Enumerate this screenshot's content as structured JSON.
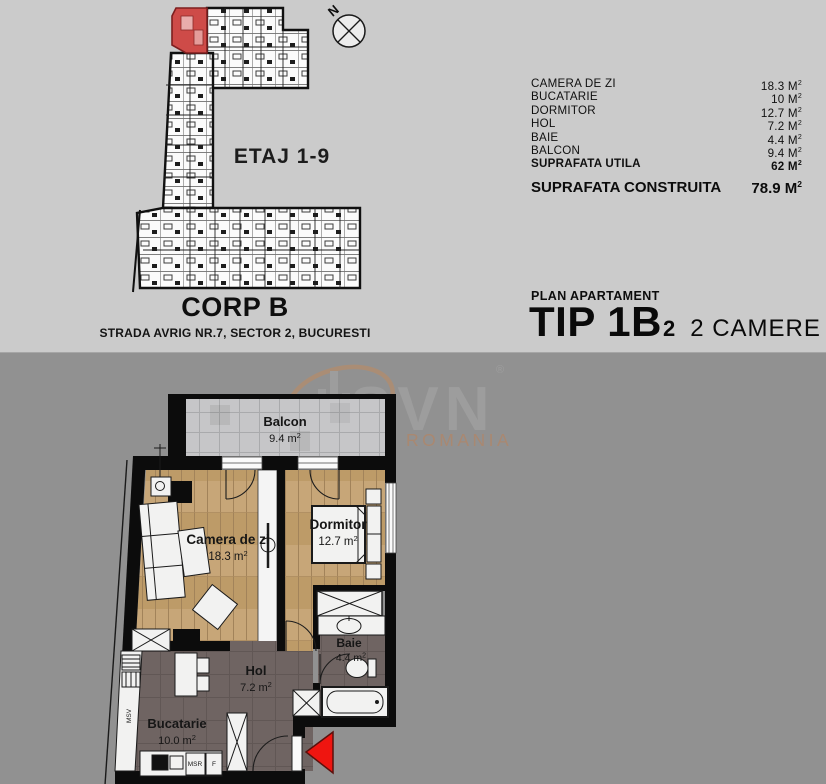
{
  "units": {
    "sup": "2"
  },
  "building": {
    "etaj": "ETAJ 1-9",
    "compass": "N",
    "corp": "CORP B",
    "address": "STRADA AVRIG NR.7, SECTOR 2, BUCURESTI"
  },
  "areas": {
    "rows": [
      {
        "label": "CAMERA DE ZI",
        "value": "18.3 M"
      },
      {
        "label": "BUCATARIE",
        "value": "10 M"
      },
      {
        "label": "DORMITOR",
        "value": "12.7 M"
      },
      {
        "label": "HOL",
        "value": "7.2 M"
      },
      {
        "label": "BAIE",
        "value": "4.4 M"
      },
      {
        "label": "BALCON",
        "value": "9.4 M"
      },
      {
        "label": "SUPRAFATA UTILA",
        "value": "62 M"
      }
    ],
    "construita": {
      "label": "SUPRAFATA CONSTRUITA",
      "value": "78.9 M"
    }
  },
  "plan_header": {
    "kicker": "PLAN APARTAMENT",
    "tip": "TIP 1B",
    "tip_sub": "2",
    "rooms": "2 CAMERE"
  },
  "floorplan": {
    "rooms": {
      "balcon": {
        "name": "Balcon",
        "area": "9.4 m"
      },
      "camera": {
        "name": "Camera de zi",
        "area": "18.3 m"
      },
      "dormitor": {
        "name": "Dormitor",
        "area": "12.7 m"
      },
      "baie": {
        "name": "Baie",
        "area": "4.4 m"
      },
      "hol": {
        "name": "Hol",
        "area": "7.2 m"
      },
      "bucatarie": {
        "name": "Bucatarie",
        "area": "10.0 m"
      }
    },
    "appliances": {
      "msv": "MSV",
      "msr": "MSR",
      "f": "F"
    }
  },
  "watermark": {
    "brand": "SVN",
    "region": "ROMANIA",
    "reg": "®"
  },
  "colors": {
    "top_bg": "#cbcbcb",
    "bottom_bg": "#919191",
    "unit_red": "#ce4b48",
    "arrow_red": "#ef1510",
    "wood": "#c7a678",
    "dark_floor": "#6f6462",
    "tile": "#c6c6c8",
    "wall": "#0c0c0c"
  }
}
